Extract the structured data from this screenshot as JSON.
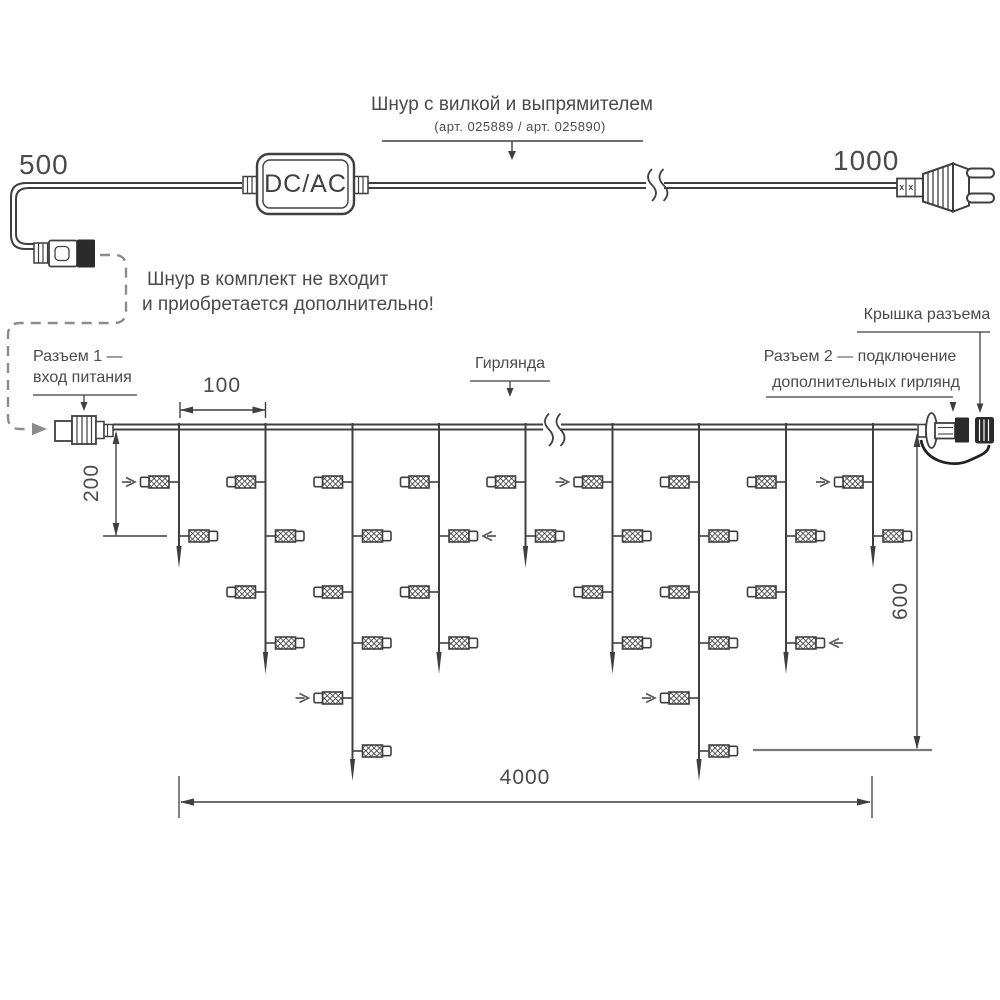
{
  "labels": {
    "cord_title": "Шнур с вилкой и выпрямителем",
    "cord_subtitle": "(арт. 025889 / арт. 025890)",
    "dim_500": "500",
    "dim_1000": "1000",
    "converter": "DC/AC",
    "note_line1": "Шнур в комплект не входит",
    "note_line2": "и приобретается дополнительно!",
    "connector1_line1": "Разъем 1 —",
    "connector1_line2": "вход питания",
    "dim_100": "100",
    "dim_200": "200",
    "garland_label": "Гирлянда",
    "cap_label": "Крышка разъема",
    "connector2_line1": "Разъем 2 — подключение",
    "connector2_line2": "дополнительных гирлянд",
    "dim_600": "600",
    "dim_4000": "4000"
  },
  "colors": {
    "line": "#3f3f3f",
    "text": "#4a4a4a",
    "dashed": "#8c8c8c",
    "black_fill": "#2b2b2b",
    "gray_tick": "#7a7a7a",
    "arrow_gray": "#5a5a5a"
  },
  "garland": {
    "wire_y": 427,
    "x_start": 113,
    "x_end": 917,
    "row_y": [
      482,
      536,
      592,
      643,
      698,
      751
    ],
    "drops": [
      {
        "x": 179,
        "tip": 568,
        "rows": 2,
        "arrow_rows": [
          1
        ]
      },
      {
        "x": 265.5,
        "tip": 674,
        "rows": 4,
        "arrow_rows": []
      },
      {
        "x": 352.5,
        "tip": 781,
        "rows": 6,
        "arrow_rows": [
          5
        ]
      },
      {
        "x": 439,
        "tip": 674,
        "rows": 4,
        "arrow_rows": [
          2
        ]
      },
      {
        "x": 525.5,
        "tip": 568,
        "rows": 2,
        "arrow_rows": []
      },
      {
        "x": 612.5,
        "tip": 674,
        "rows": 4,
        "arrow_rows": [
          1
        ]
      },
      {
        "x": 699,
        "tip": 781,
        "rows": 6,
        "arrow_rows": [
          5
        ]
      },
      {
        "x": 786,
        "tip": 674,
        "rows": 4,
        "arrow_rows": [
          4
        ]
      },
      {
        "x": 873,
        "tip": 568,
        "rows": 2,
        "arrow_rows": [
          1
        ]
      }
    ]
  }
}
